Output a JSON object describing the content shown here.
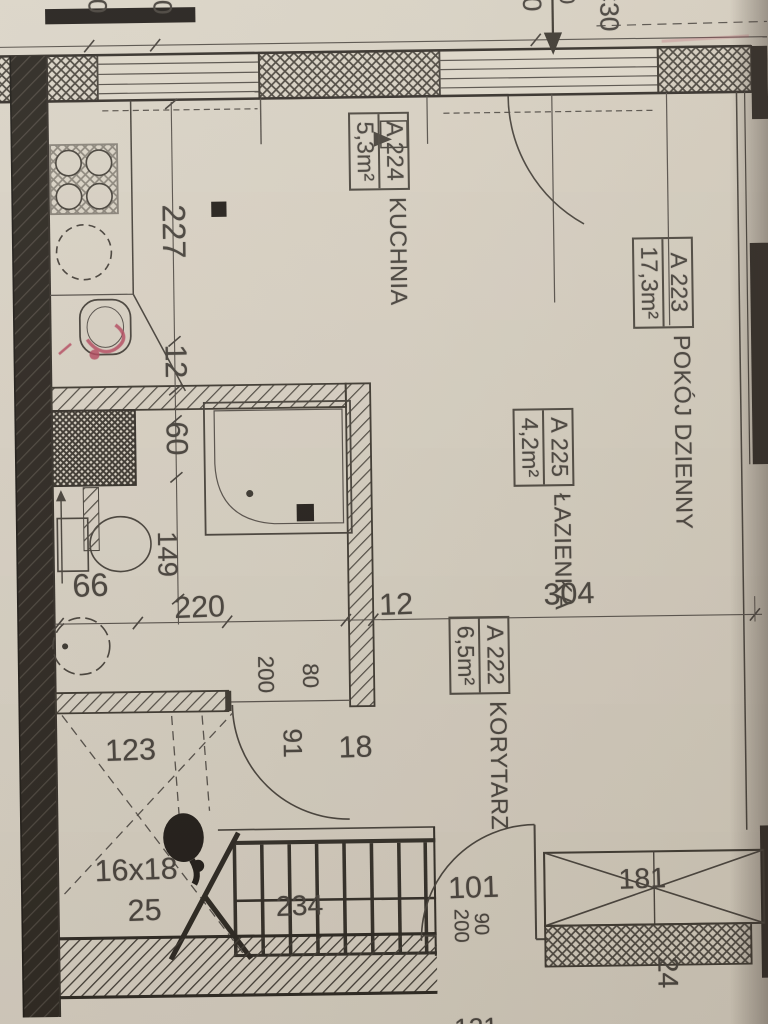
{
  "drawing": {
    "kind": "scanned architectural floor plan, rotated 90 degrees",
    "language": "Polish"
  },
  "rooms": [
    {
      "code": "A 224",
      "name": "KUCHNIA",
      "area": "5,3m²"
    },
    {
      "code": "A 223",
      "name": "POKÓJ DZIENNY",
      "area": "17,3m²"
    },
    {
      "code": "A 225",
      "name": "ŁAZIENKA",
      "area": "4,2m²"
    },
    {
      "code": "A 222",
      "name": "KORYTARZ",
      "area": "6,5m²"
    }
  ],
  "dims": {
    "d227": "227",
    "d12a": "12",
    "d60": "60",
    "d149": "149",
    "d66": "66",
    "d220": "220",
    "d12b": "12",
    "d304": "304",
    "d123": "123",
    "d91": "91",
    "d18": "18",
    "d80": "80",
    "d200a": "200",
    "d16x18": "16x18",
    "d25": "25",
    "d234": "234",
    "d101": "101",
    "d90": "90",
    "d200b": "200",
    "d181": "181",
    "d24": "24",
    "d30a": "30",
    "d30b": "30",
    "d40": "40",
    "d0": "0",
    "dC30": "C30",
    "d121": "121"
  },
  "colors": {
    "paper": "#d7d0c2",
    "ink": "#46413b",
    "wall_dark": "#2b2620",
    "red_mark": "#b5455c"
  }
}
